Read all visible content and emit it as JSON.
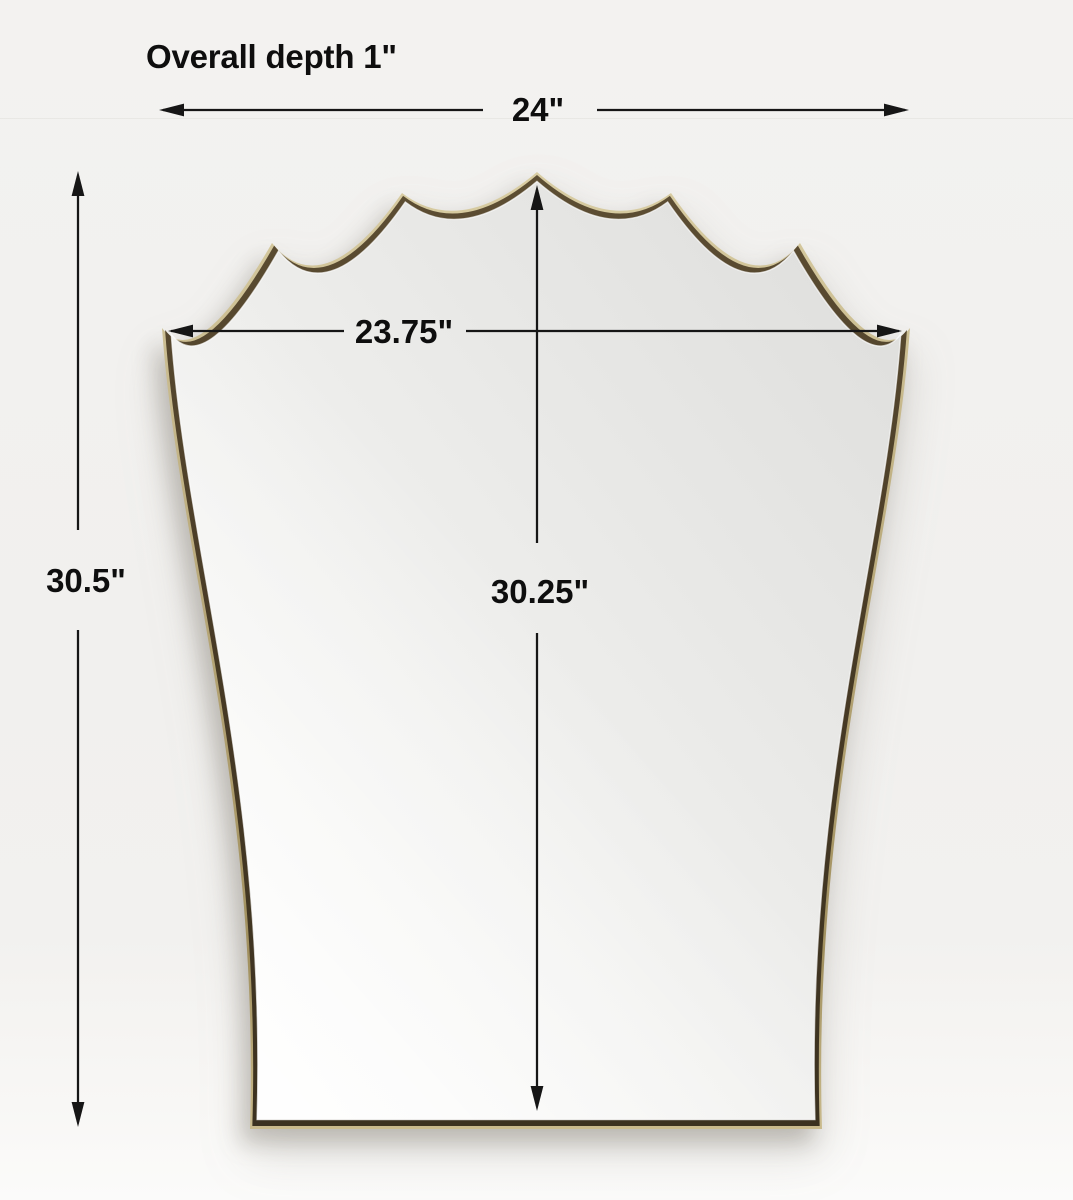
{
  "canvas": {
    "width": 1073,
    "height": 1200,
    "background": "#f1f0ee"
  },
  "annotations": {
    "overall_depth": "Overall depth 1\"",
    "overall_width": "24\"",
    "mirror_width": "23.75\"",
    "overall_height": "30.5\"",
    "mirror_height": "30.25\""
  },
  "mirror": {
    "shape": "scalloped-crown-shield-mirror",
    "frame_outer_color": "#c2b283",
    "frame_inner_color": "#483a25",
    "glass_color": "#ebebe9"
  },
  "colors": {
    "dimension_line": "#161616",
    "text": "#0e0e0e"
  }
}
